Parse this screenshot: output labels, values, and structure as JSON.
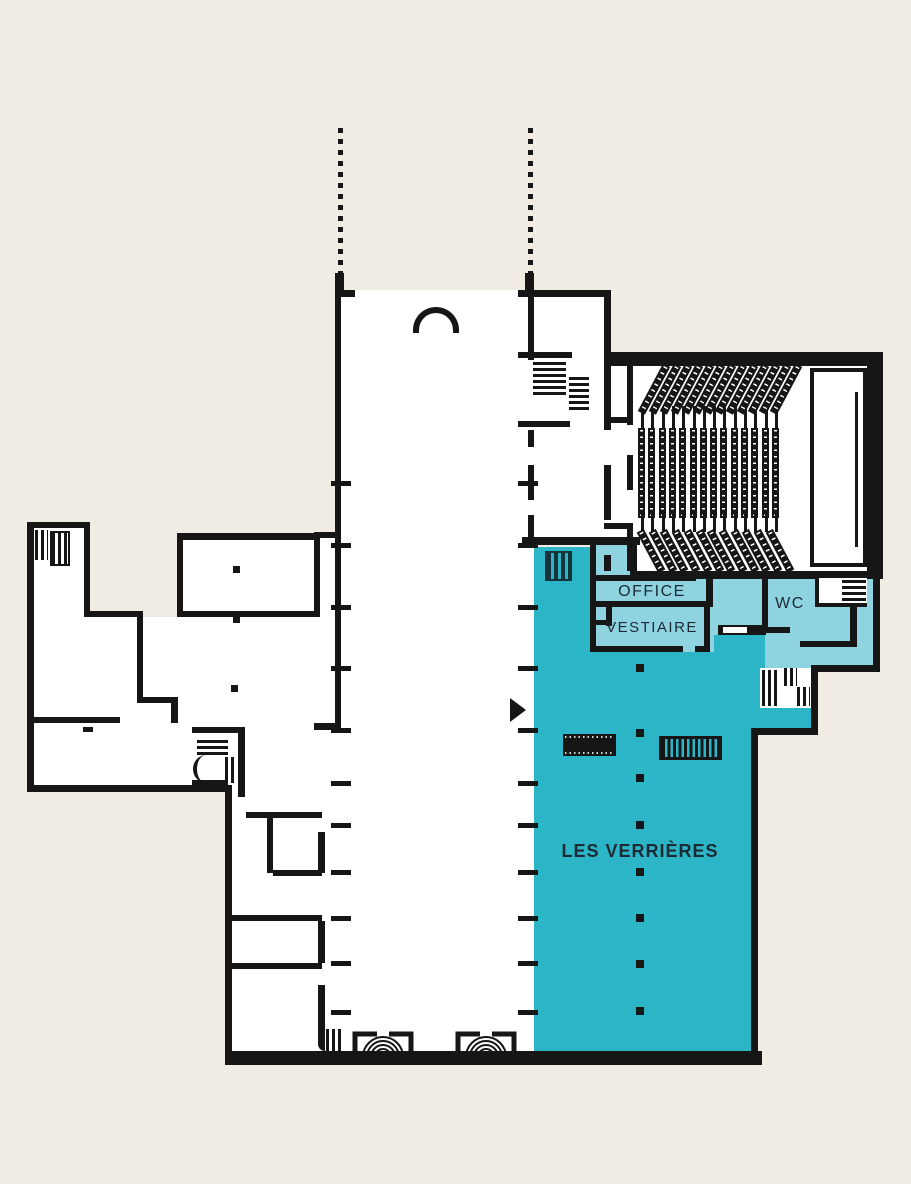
{
  "labels": {
    "office": "OFFICE",
    "vestiaire": "VESTIAIRE",
    "wc": "WC",
    "les_verrieres": "LES VERRIÈRES"
  },
  "colors": {
    "background": "#f0ebe3",
    "wall": "#161616",
    "zone_teal": "#2cb4c7",
    "zone_light": "#8fd3e1",
    "label_text": "#1b2a33"
  },
  "theater": {
    "seat_rows_straight": 14,
    "seat_rows_top": 13,
    "seat_rows_bottom": 12
  },
  "hall": {
    "dotted_line_xs": [
      338,
      528
    ],
    "tick_ys": [
      483,
      545,
      607,
      668,
      730,
      783,
      825,
      872,
      918,
      963,
      1012
    ],
    "column_dot_x": 636,
    "column_dot_ys": [
      668,
      733,
      778,
      825,
      872,
      918,
      964,
      1011
    ]
  },
  "wing_dots": [
    [
      233,
      566
    ],
    [
      233,
      616
    ],
    [
      231,
      685
    ]
  ]
}
